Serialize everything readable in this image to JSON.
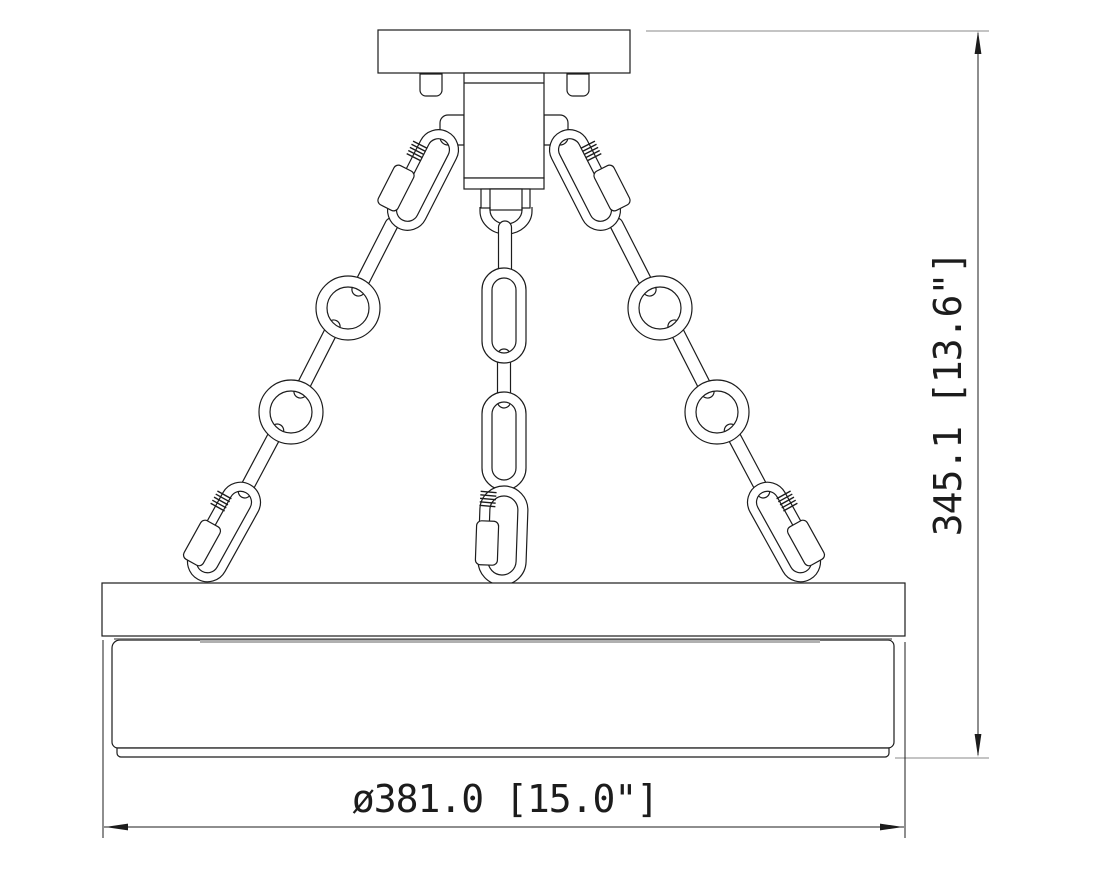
{
  "drawing": {
    "height_dimension": {
      "label": "345.1 [13.6\"]",
      "millimeters": "345.1",
      "inches": "13.6\""
    },
    "diameter_dimension": {
      "label": "ø381.0 [15.0\"]",
      "millimeters": "381.0",
      "inches": "15.0\"",
      "diameter_symbol": "ø"
    },
    "colors": {
      "line": "#1c1c1c",
      "extension_line": "#8a8a8a",
      "shade_seam_dark": "#707070",
      "shade_seam_light": "#b0b0b0",
      "background": "#ffffff"
    }
  }
}
